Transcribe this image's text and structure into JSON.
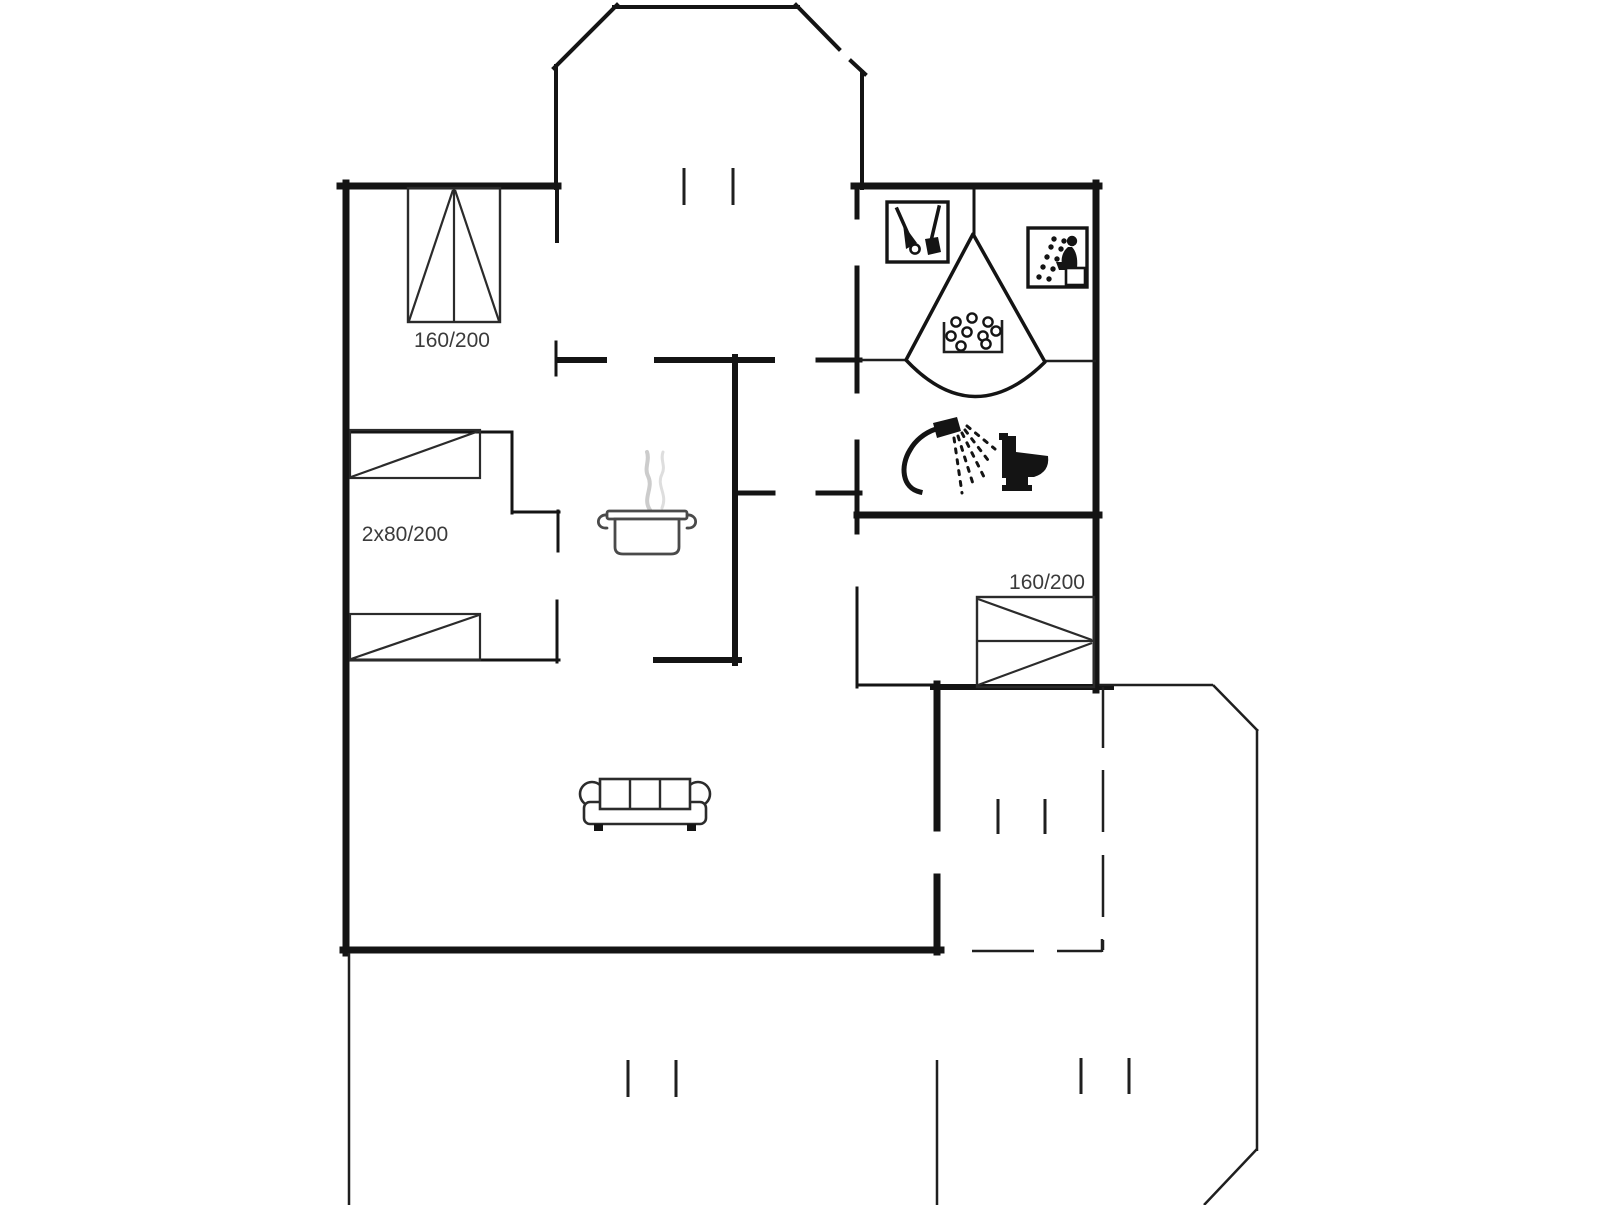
{
  "floor_plan": {
    "type": "holiday-home-floor-plan",
    "labels": {
      "bed_top_left": "160/200",
      "bed_left": "2x80/200",
      "bed_right": "160/200"
    },
    "colors": {
      "wall": "#141414",
      "thin_line": "#1f1f1f",
      "bed_line": "#2b2b2b",
      "label_text": "#3b3b3b",
      "steam": "#cccccc",
      "background": "#ffffff"
    },
    "icons": [
      "cleaning-equipment-icon",
      "sauna-icon",
      "corner-whirlpool-tub-icon",
      "shower-icon",
      "toilet-icon",
      "cooking-pot-icon",
      "sofa-icon"
    ],
    "symbols": {
      "double_bed_count": 2,
      "single_bed_count": 2,
      "window_opening_mark_pairs": 4,
      "dashed_boundary": "covered terrace"
    }
  }
}
